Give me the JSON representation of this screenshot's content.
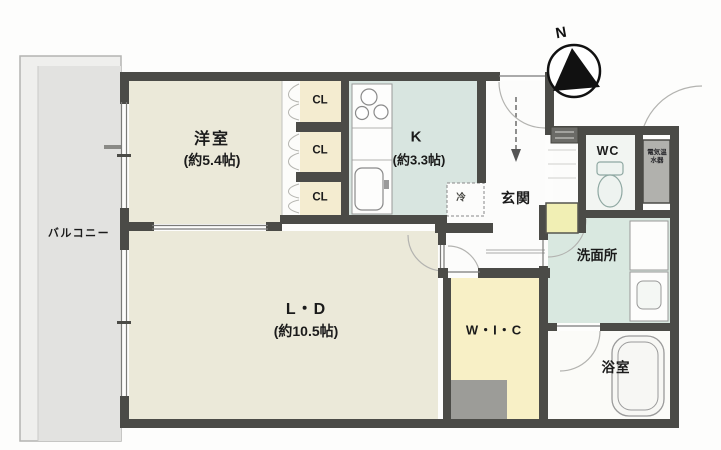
{
  "compass": {
    "label": "N"
  },
  "balcony": {
    "label": "バルコニー"
  },
  "rooms": {
    "western_room": {
      "label": "洋室",
      "size": "(約5.4帖)"
    },
    "kitchen": {
      "label": "K",
      "size": "(約3.3帖)"
    },
    "living_dining": {
      "label": "L・D",
      "size": "(約10.5帖)"
    },
    "entrance": {
      "label": "玄関"
    },
    "wc": {
      "label": "WC"
    },
    "washroom": {
      "label": "洗面所"
    },
    "bathroom": {
      "label": "浴室"
    },
    "walk_in_closet": {
      "label": "W・I・C"
    }
  },
  "closets": [
    {
      "label": "CL"
    },
    {
      "label": "CL"
    },
    {
      "label": "CL"
    }
  ],
  "fixtures": {
    "refrigerator_label": "冷",
    "water_heater_label": "電気温水器"
  },
  "colors": {
    "wall": "#4b4b47",
    "room_cream": "#ebe9d9",
    "closet_cream": "#f4ecd0",
    "kitchen_blue": "#d8e5e0",
    "washroom_green": "#d9e8e0",
    "wic_yellow": "#f8f0c6",
    "shoe_cabinet_yellow": "#f1efb4",
    "balcony_gray": "#e2e2e0",
    "pillar_gray": "#9c9c98",
    "water_heater_gray": "#b1b1ad"
  }
}
